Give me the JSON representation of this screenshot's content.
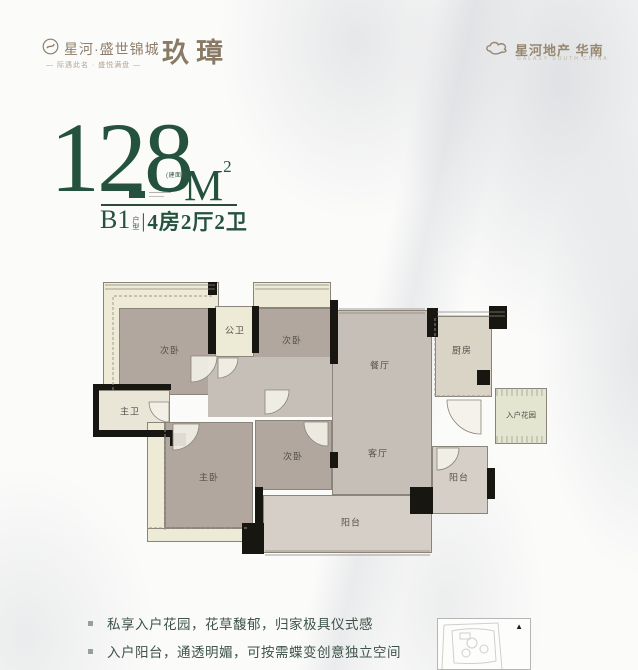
{
  "header": {
    "logo_left": {
      "project": "星河·盛世锦城",
      "product": "玖璋",
      "tagline": "— 际遇此名 · 盛悦满盘 —"
    },
    "logo_right": {
      "name": "星河地产 华南",
      "sub": "GALAXY SOUTH CHINA"
    }
  },
  "title": {
    "area": "128",
    "area_note": "(建面约)",
    "unit": "M",
    "unit_sup": "2",
    "model": "B1",
    "model_tag_1": "户",
    "model_tag_2": "型",
    "divider": "|",
    "layout": "4房2厅2卫"
  },
  "floorplan": {
    "rooms": {
      "bed1": "次卧",
      "public_bath": "公卫",
      "bed2": "次卧",
      "dining": "餐厅",
      "kitchen": "厨房",
      "entry_garden": "入户花园",
      "master_bath": "主卫",
      "master_bed": "主卧",
      "bed3": "次卧",
      "living": "客厅",
      "utility_balcony": "阳台",
      "balcony": "阳台"
    }
  },
  "features": {
    "item1": "私享入户花园，花草馥郁，归家极具仪式感",
    "item2": "入户阳台，通透明媚，可按需蝶变创意独立空间"
  },
  "colors": {
    "accent_green": "#24523e",
    "logo_brown": "#8d7e6a",
    "wall_black": "#181611",
    "room_taupe": "#b1a79f",
    "room_grey": "#c6bfb8",
    "room_cream": "#edead6",
    "text_green": "#3e5348"
  }
}
